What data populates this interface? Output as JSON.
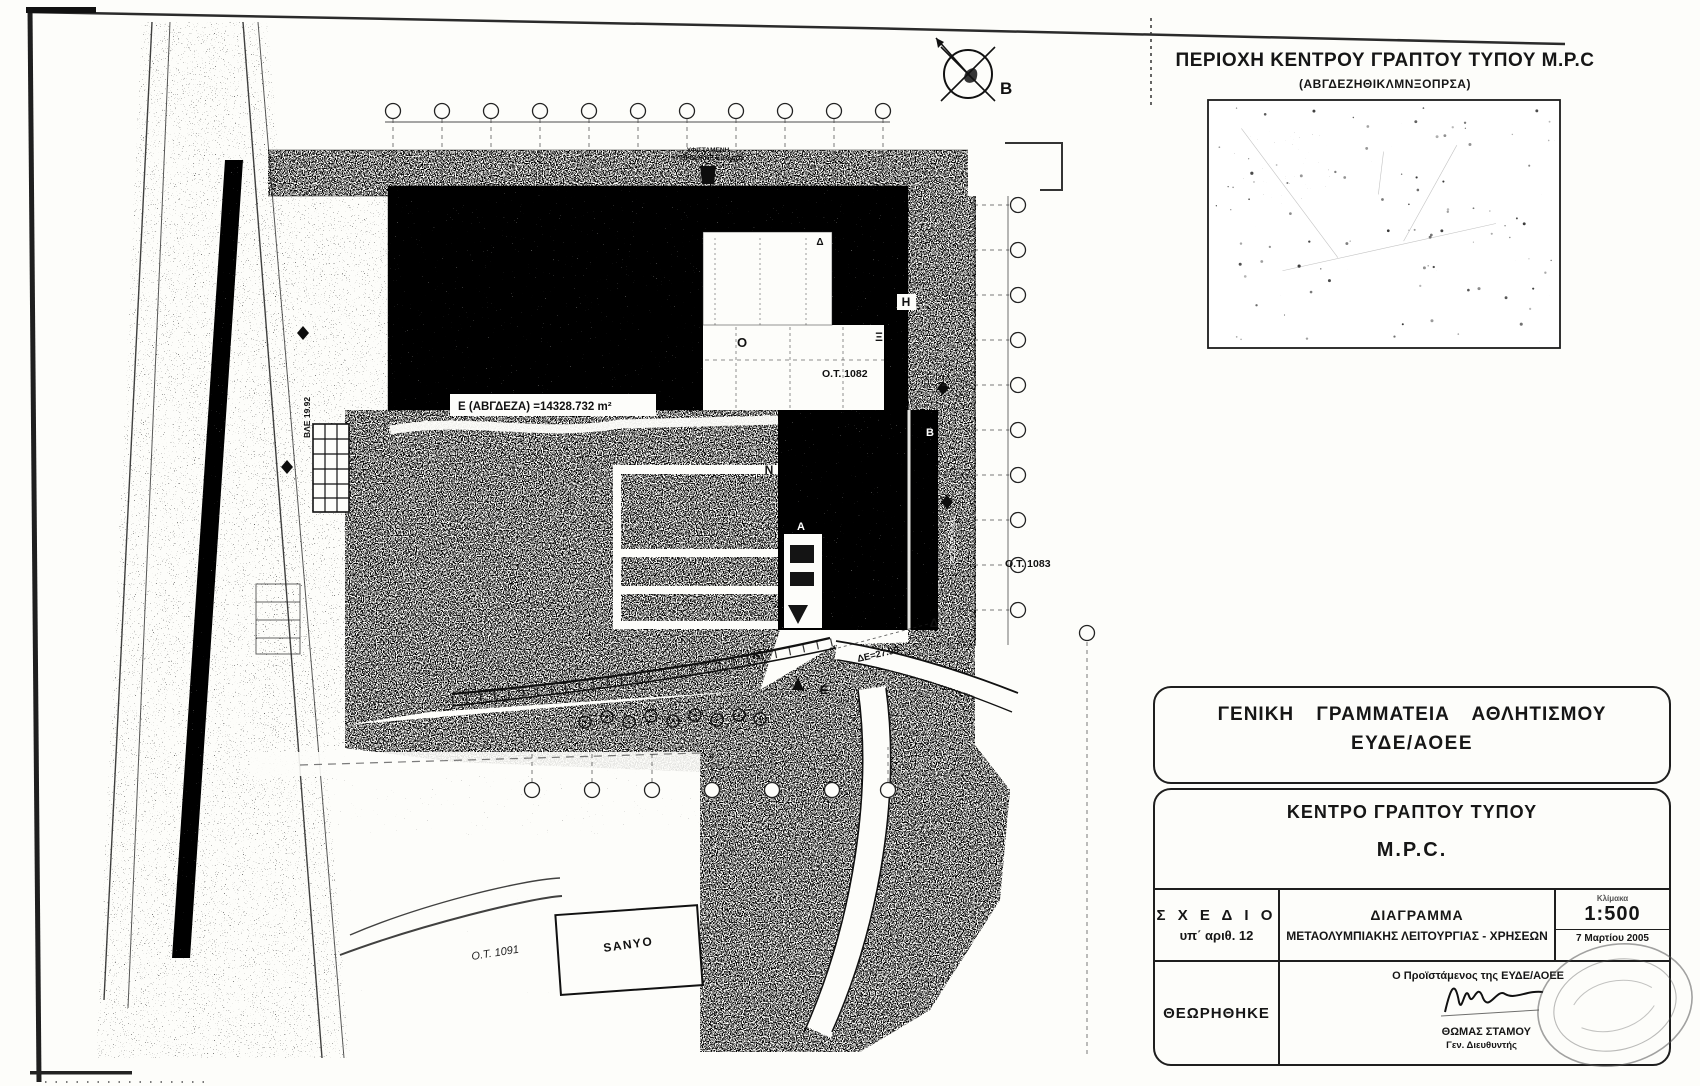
{
  "inset": {
    "title": "ΠΕΡΙΟΧΗ ΚΕΝΤΡΟΥ ΓΡΑΠΤΟΥ ΤΥΠΟΥ Μ.Ρ.C",
    "subtitle": "(ΑΒΓΔΕΖΗΘΙΚΛΜΝΞΟΠΡΣΑ)"
  },
  "plan": {
    "area_label": "Ε (ΑΒΓΔΕΖΑ) =14328.732 m²",
    "ot_1082": "Ο.Τ. 1082",
    "ot_1083": "Ο.Τ. 1083",
    "ot_1091": "Ο.Τ. 1091",
    "sanyo": "SANYO",
    "north_letter": "Β",
    "dim_label": "ΔΕ=27.99",
    "bd_label": "ΒΛΕ 19.92",
    "street_label": "ΠΕΖΟΔΡΟΜΟΣ",
    "entrance_line1": "ΥΦΙΣΤΑΜΕΝΗ",
    "entrance_line2": "ΥΠΗΡΕΣΙΑΚΗ ΕΙΣΟΔΟΣ",
    "letters": [
      {
        "ch": "Ο",
        "x": 742,
        "y": 347,
        "c": "#111",
        "s": 13
      },
      {
        "ch": "Ξ",
        "x": 879,
        "y": 341,
        "c": "#111",
        "s": 12
      },
      {
        "ch": "Η",
        "x": 906,
        "y": 306,
        "c": "#111",
        "s": 12
      },
      {
        "ch": "Δ",
        "x": 820,
        "y": 245,
        "c": "#111",
        "s": 10
      },
      {
        "ch": "Ν",
        "x": 769,
        "y": 474,
        "c": "#111",
        "s": 12
      },
      {
        "ch": "Β",
        "x": 930,
        "y": 436,
        "c": "#ffffff",
        "s": 11
      },
      {
        "ch": "Α",
        "x": 801,
        "y": 530,
        "c": "#ffffff",
        "s": 11
      },
      {
        "ch": "Δ",
        "x": 934,
        "y": 627,
        "c": "#111",
        "s": 12
      },
      {
        "ch": "Κ",
        "x": 757,
        "y": 659,
        "c": "#111",
        "s": 12
      },
      {
        "ch": "Ε",
        "x": 824,
        "y": 694,
        "c": "#111",
        "s": 12
      }
    ]
  },
  "titleblock": {
    "org_line1": "ΓΕΝΙΚΗ ΓΡΑΜΜΑΤΕΙΑ ΑΘΛΗΤΙΣΜΟΥ",
    "org_line2": "ΕΥΔΕ/ΑΟΕΕ",
    "project_line1": "ΚΕΝΤΡΟ ΓΡΑΠΤΟΥ ΤΥΠΟΥ",
    "project_line2": "Μ.Ρ.C.",
    "plan_label": "Σ Χ Ε Δ Ι Ο",
    "plan_no": "υπ΄ αριθ. 12",
    "drawing_title1": "ΔΙΑΓΡΑΜΜΑ",
    "drawing_title2": "ΜΕΤΑΟΛΥΜΠΙΑΚΗΣ ΛΕΙΤΟΥΡΓΙΑΣ - ΧΡΗΣΕΩΝ",
    "scale_label": "Κλίμακα",
    "scale_value": "1:500",
    "date": "7 Μαρτίου 2005",
    "approved": "ΘΕΩΡΗΘΗΚΕ",
    "signatory_role": "Ο Προϊστάμενος της ΕΥΔΕ/ΑΟΕΕ",
    "signatory_name": "ΘΩΜΑΣ ΣΤΑΜΟΥ",
    "signatory_title": "Γεν. Διευθυντής"
  }
}
